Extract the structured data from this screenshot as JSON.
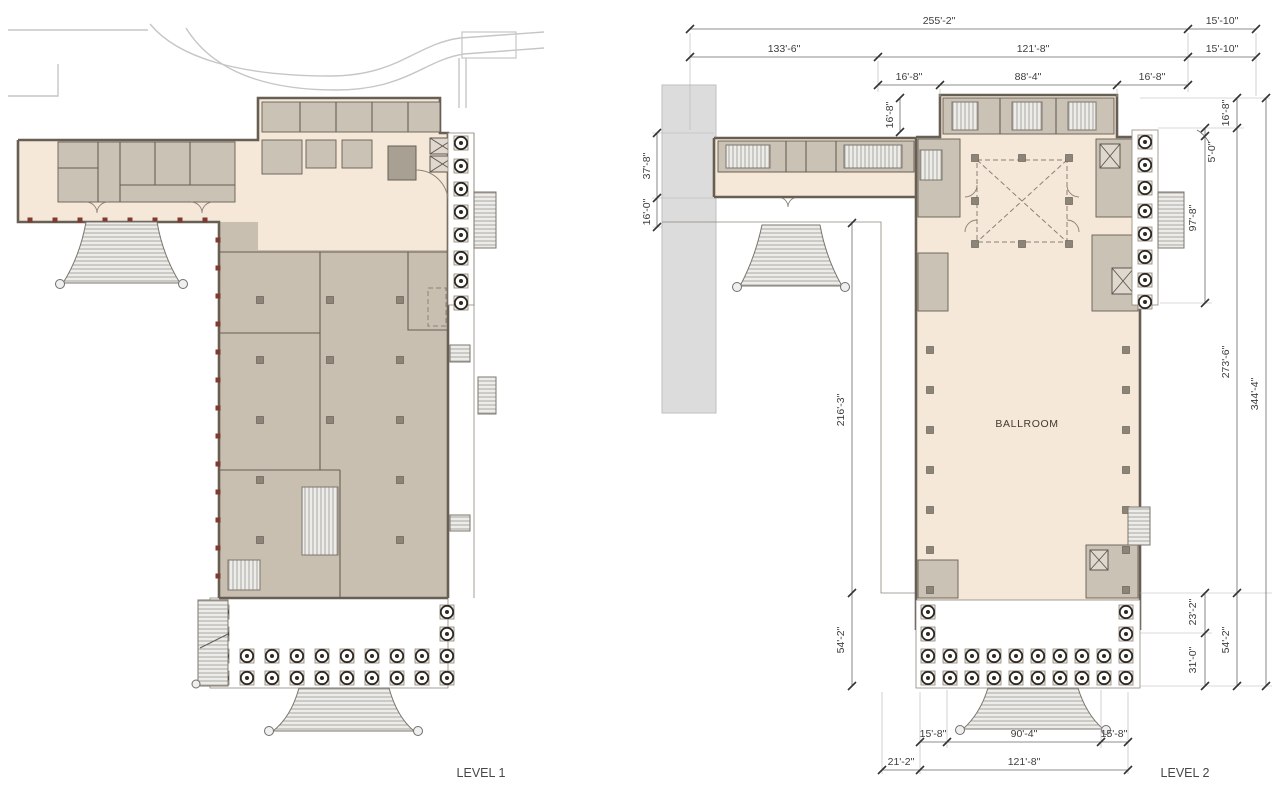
{
  "labels": {
    "level1": "LEVEL 1",
    "level2": "LEVEL 2",
    "ballroom": "BALLROOM"
  },
  "level2": {
    "dims": {
      "top_total": "255'-2\"",
      "top_right_a": "15'-10\"",
      "top_wing": "133'-6\"",
      "top_main": "121'-8\"",
      "top_right_b": "15'-10\"",
      "top_aisle_left": "16'-8\"",
      "top_ballroom": "88'-4\"",
      "top_aisle_right": "16'-8\"",
      "left_bar": "16'-8\"",
      "left_wing_depth": "37'-8\"",
      "left_terrace": "16'-0\"",
      "left_main": "216'-3\"",
      "left_portico": "54'-2\"",
      "right_top": "16'-8\"",
      "right_five": "5'-0\"",
      "right_colonnade": "97'-8\"",
      "right_main": "273'-6\"",
      "right_total": "344'-4\"",
      "right_upper_portico": "23'-2\"",
      "right_lower_portico": "31'-0\"",
      "right_portico": "54'-2\"",
      "bottom_col_left": "15'-8\"",
      "bottom_portico": "90'-4\"",
      "bottom_col_right": "15'-8\"",
      "bottom_left": "21'-2\"",
      "bottom_main": "121'-8\""
    }
  },
  "colors": {
    "floor_cream": "#f5e8d8",
    "hall_tan": "#c9bfb1",
    "room_gray": "#cbc2b6",
    "mass_gray": "#a9a094",
    "wall_dark": "#675f54",
    "context_gray": "#dcdcdc",
    "dim_text": "#3d3d3d",
    "accent_red": "#7e3b2f",
    "column_ink": "#2e2922"
  }
}
